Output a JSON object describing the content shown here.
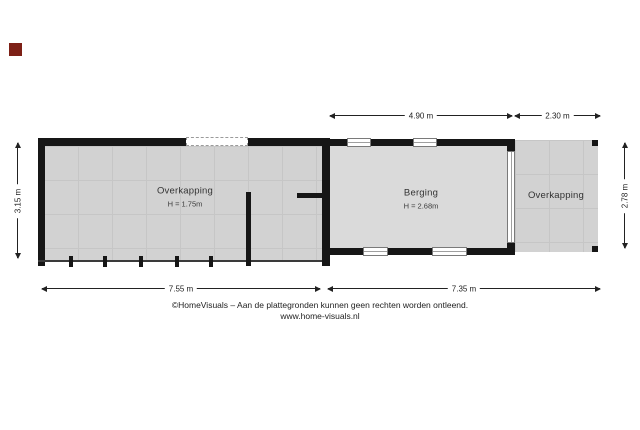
{
  "marker": {
    "style": "background:#7d2016"
  },
  "plan": {
    "rooms": {
      "left": {
        "label": "Overkapping",
        "height": "H = 1.75m"
      },
      "berging": {
        "label": "Berging",
        "height": "H = 2.68m"
      },
      "right": {
        "label": "Overkapping"
      }
    },
    "dimensions": {
      "top_1": "4.90 m",
      "top_2": "2.30 m",
      "left": "3.15 m",
      "right": "2.78 m",
      "bottom_1": "7.55 m",
      "bottom_2": "7.35 m"
    }
  },
  "footer": {
    "disclaimer": "©HomeVisuals – Aan de plattegronden kunnen geen rechten worden ontleend.",
    "website": "www.home-visuals.nl"
  }
}
